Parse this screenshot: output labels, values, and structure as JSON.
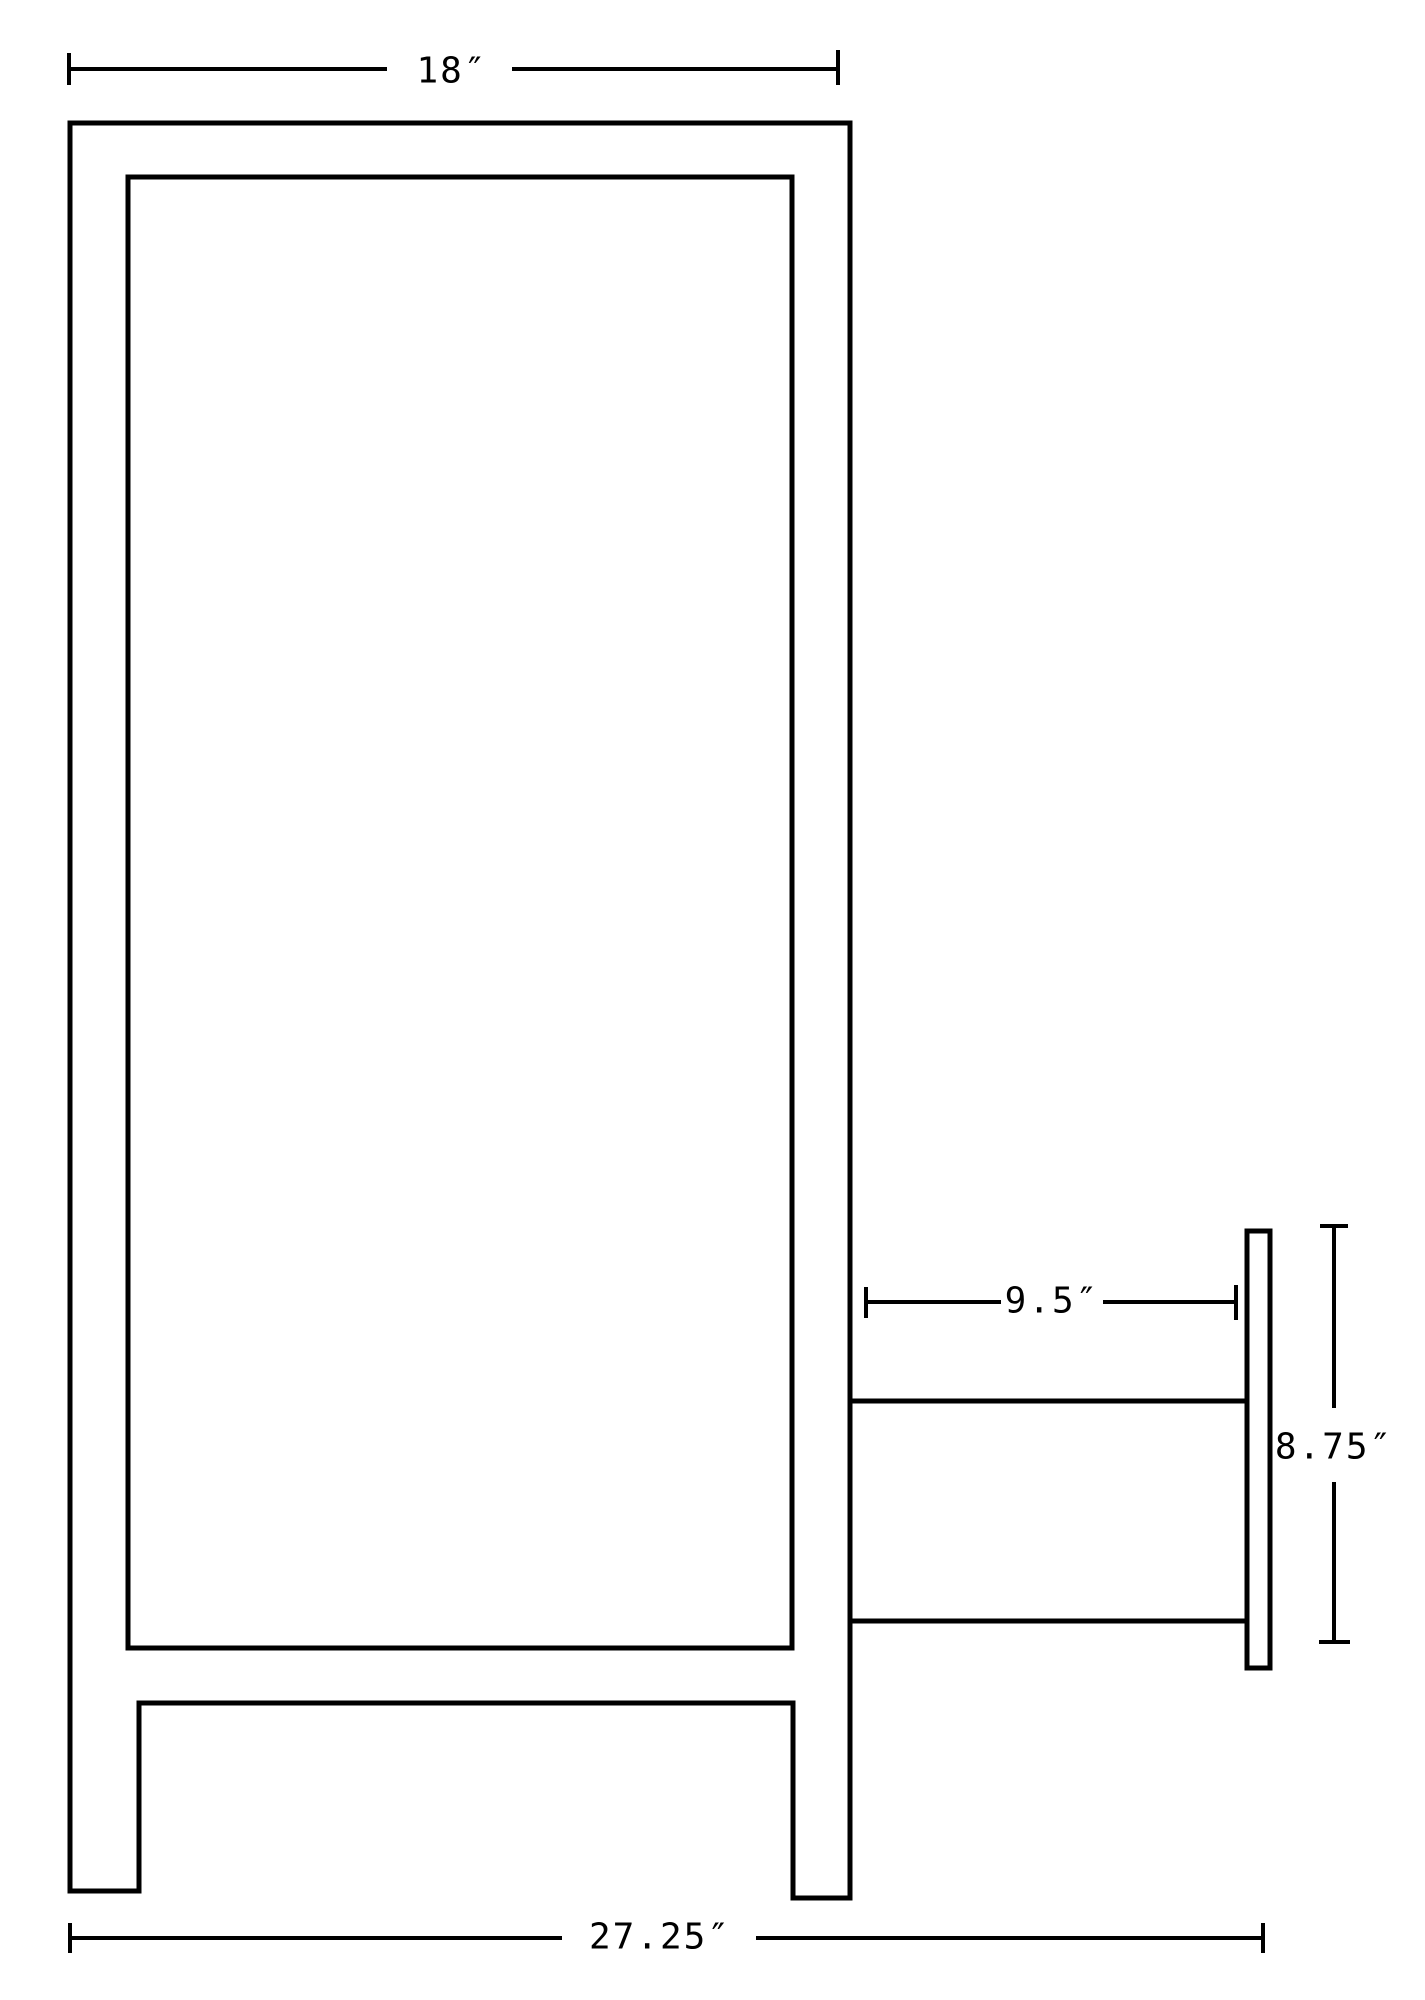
{
  "page": {
    "background_color": "#ffffff",
    "line_color": "#000000"
  },
  "drawing": {
    "name": "cabinet-side-elevation-technical-drawing",
    "description": "Black-and-white side elevation line drawing of a cabinet with legs and a rear wall-mount bracket, annotated with dimension lines",
    "dims": {
      "top_width": {
        "label": "18″",
        "value_inches": 18
      },
      "bracket_depth": {
        "label": "9.5″",
        "value_inches": 9.5
      },
      "bracket_height": {
        "label": "8.75″",
        "value_inches": 8.75
      },
      "overall_depth": {
        "label": "27.25″",
        "value_inches": 27.25
      }
    }
  }
}
